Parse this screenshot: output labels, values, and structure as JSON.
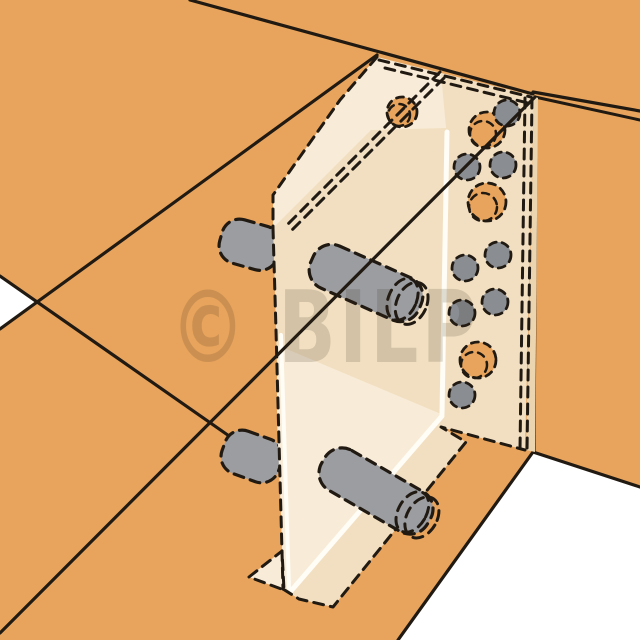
{
  "illustration": {
    "title": "timber-concealed-connector-diagram",
    "watermark": "© BILP",
    "canvas": {
      "width": 640,
      "height": 640
    },
    "colors": {
      "background": "#FFFFFF",
      "wood": "#E8A45C",
      "plate": "#F2DFC1",
      "plate_light": "#F8ECD8",
      "plate_edge": "#EBD5B1",
      "steel": "#9B9DA1",
      "pin": "#8A8D92",
      "line": "#211A12",
      "highlight": "#FFFDF5",
      "watermark_color": "#3A2F1E"
    },
    "watermark_style": {
      "x": 170,
      "y": 362,
      "size": 100,
      "text_length": 310,
      "opacity": 0.16
    },
    "shapes": [
      {
        "t": "rect",
        "n": "background",
        "x": 0,
        "y": 0,
        "w": 640,
        "h": 640,
        "f": "background"
      },
      {
        "t": "poly",
        "n": "wood-surfaces",
        "p": "0,0 640,0 640,640 0,640",
        "f": "wood"
      },
      {
        "t": "poly",
        "n": "background-notch-left",
        "p": "0,276 37,302 0,329",
        "f": "background"
      },
      {
        "t": "poly",
        "n": "background-opening-bottom-right",
        "p": "533,452 640,487 640,640 398,640",
        "f": "background"
      },
      {
        "t": "line",
        "n": "header-beam-top-edge",
        "x1": 190,
        "y1": 0,
        "x2": 533,
        "y2": 94,
        "s": "line",
        "sw": 3.2
      },
      {
        "t": "line",
        "n": "header-beam-bottom-edge",
        "x1": 0,
        "y1": 329,
        "x2": 377,
        "y2": 55,
        "s": "line",
        "sw": 3.2
      },
      {
        "t": "line",
        "n": "carried-beam-arris-left",
        "x1": 0,
        "y1": 276,
        "x2": 232,
        "y2": 438,
        "s": "line",
        "sw": 3.2
      },
      {
        "t": "line",
        "n": "carried-beam-end-edge",
        "x1": 371,
        "y1": 130,
        "x2": 273,
        "y2": 228,
        "s": "line",
        "sw": 3
      },
      {
        "t": "line",
        "n": "header-edge-right-upper",
        "x1": 533,
        "y1": 92,
        "x2": 640,
        "y2": 111,
        "s": "line",
        "sw": 3.2
      },
      {
        "t": "line",
        "n": "header-edge-right-lower",
        "x1": 535,
        "y1": 97,
        "x2": 640,
        "y2": 120,
        "s": "line",
        "sw": 3
      },
      {
        "t": "line",
        "n": "post-front-arris",
        "x1": 536,
        "y1": 98,
        "x2": 534,
        "y2": 452,
        "s": "line",
        "sw": 3.2
      },
      {
        "t": "line",
        "n": "post-base-edge-right",
        "x1": 533,
        "y1": 452,
        "x2": 640,
        "y2": 487,
        "s": "line",
        "sw": 3.2
      },
      {
        "t": "line",
        "n": "post-base-edge-left",
        "x1": 533,
        "y1": 452,
        "x2": 398,
        "y2": 640,
        "s": "line",
        "sw": 3.2
      },
      {
        "t": "rect",
        "n": "dowel-end-upper",
        "x": 220,
        "y": 222,
        "w": 60,
        "h": 45,
        "rx": 18,
        "tf": "rotate(16 249 244)",
        "f": "steel",
        "s": "line",
        "sw": 3.2,
        "d": 1
      },
      {
        "t": "rect",
        "n": "dowel-end-lower",
        "x": 222,
        "y": 434,
        "w": 60,
        "h": 45,
        "rx": 18,
        "tf": "rotate(20 252 456)",
        "f": "steel",
        "s": "line",
        "sw": 3.2,
        "d": 1
      },
      {
        "t": "poly",
        "n": "plate-body",
        "p": "377,57 534,96 525,450 441,427 466,442 333,607 299,599 283,589 276,330 273,228 273,195 340,100",
        "f": "plate"
      },
      {
        "t": "poly",
        "n": "plate-flange-top",
        "p": "377,57 441,74 446,128 371,130 273,228 273,195 340,100",
        "f": "plate_light"
      },
      {
        "t": "poly",
        "n": "plate-lower-left-face",
        "p": "277,345 441,414 291,590 284,588 277,420",
        "f": "plate_light"
      },
      {
        "t": "poly",
        "n": "plate-edge-strip",
        "p": "534,96 538,98 535,452 526,450",
        "f": "plate_edge"
      },
      {
        "t": "poly",
        "n": "plate-foot-flange",
        "p": "249,577 282,551 284,590",
        "f": "plate_light",
        "s": "line",
        "sw": 3,
        "d": 1
      },
      {
        "t": "line",
        "n": "plate-fold-highlight-upper",
        "x1": 447,
        "y1": 132,
        "x2": 442,
        "y2": 414,
        "s": "highlight",
        "sw": 5
      },
      {
        "t": "line",
        "n": "plate-fold-highlight-lower",
        "x1": 442,
        "y1": 416,
        "x2": 291,
        "y2": 591,
        "s": "highlight",
        "sw": 5
      },
      {
        "t": "line",
        "n": "plate-edge-highlight-left",
        "x1": 281,
        "y1": 335,
        "x2": 289,
        "y2": 588,
        "s": "highlight",
        "sw": 4
      },
      {
        "t": "pline",
        "n": "plate-top-edge-dashed-outer",
        "p": "379,60 531,97",
        "s": "line",
        "sw": 3,
        "d": 1
      },
      {
        "t": "pline",
        "n": "plate-top-edge-dashed-inner",
        "p": "385,68 528,103",
        "s": "line",
        "sw": 3,
        "d": 1
      },
      {
        "t": "pline",
        "n": "plate-left-edge-dashed",
        "p": "377,57 340,100 273,195 273,228",
        "s": "line",
        "sw": 3,
        "d": 1
      },
      {
        "t": "pline",
        "n": "plate-side-edge-dashed",
        "p": "273,228 276,330 283,589",
        "s": "line",
        "sw": 3,
        "d": 1
      },
      {
        "t": "pline",
        "n": "plate-bottom-edge-dashed",
        "p": "283,589 299,599 333,607 466,442 441,427 525,450",
        "s": "line",
        "sw": 3,
        "d": 1
      },
      {
        "t": "pline",
        "n": "plate-right-edge-dashed-outer",
        "p": "532,98 527,451",
        "s": "line",
        "sw": 3,
        "d": 1
      },
      {
        "t": "pline",
        "n": "plate-right-edge-dashed-inner",
        "p": "525,98 520,449",
        "s": "line",
        "sw": 3,
        "d": 1
      },
      {
        "t": "circle",
        "n": "flange-hole",
        "cx": 402,
        "cy": 112,
        "r": 15,
        "f": "wood",
        "s": "line",
        "sw": 2.8,
        "d": 2
      },
      {
        "t": "circle",
        "n": "flange-hole-rim",
        "cx": 399,
        "cy": 115,
        "r": 11,
        "s": "line",
        "sw": 2.5,
        "d": 2
      },
      {
        "t": "circle",
        "n": "plate-hole-1",
        "cx": 487,
        "cy": 130,
        "r": 18,
        "f": "wood",
        "s": "line",
        "sw": 2.8,
        "d": 2
      },
      {
        "t": "circle",
        "n": "plate-hole-1-rim",
        "cx": 483,
        "cy": 134,
        "r": 13,
        "s": "line",
        "sw": 2.5,
        "d": 2
      },
      {
        "t": "circle",
        "n": "plate-hole-2",
        "cx": 487,
        "cy": 202,
        "r": 19,
        "f": "wood",
        "s": "line",
        "sw": 2.8,
        "d": 2
      },
      {
        "t": "circle",
        "n": "plate-hole-2-rim",
        "cx": 483,
        "cy": 207,
        "r": 14,
        "s": "line",
        "sw": 2.5,
        "d": 2
      },
      {
        "t": "circle",
        "n": "plate-hole-3",
        "cx": 478,
        "cy": 360,
        "r": 18,
        "f": "wood",
        "s": "line",
        "sw": 2.8,
        "d": 2
      },
      {
        "t": "circle",
        "n": "plate-hole-3-rim",
        "cx": 474,
        "cy": 365,
        "r": 13,
        "s": "line",
        "sw": 2.5,
        "d": 2
      },
      {
        "t": "pline",
        "n": "hidden-beam-edge-dashed-a",
        "p": "440,72 284,228",
        "s": "line",
        "sw": 3,
        "d": 1
      },
      {
        "t": "pline",
        "n": "hidden-beam-edge-dashed-b",
        "p": "444,78 288,234",
        "s": "line",
        "sw": 3,
        "d": 1
      },
      {
        "t": "circle",
        "n": "fastener-pin-1",
        "cx": 507,
        "cy": 113,
        "r": 13,
        "f": "pin",
        "s": "line",
        "sw": 2.8,
        "d": 2
      },
      {
        "t": "circle",
        "n": "fastener-pin-2",
        "cx": 467,
        "cy": 167,
        "r": 13,
        "f": "pin",
        "s": "line",
        "sw": 2.8,
        "d": 2
      },
      {
        "t": "circle",
        "n": "fastener-pin-3",
        "cx": 503,
        "cy": 165,
        "r": 13,
        "f": "pin",
        "s": "line",
        "sw": 2.8,
        "d": 2
      },
      {
        "t": "circle",
        "n": "fastener-pin-4",
        "cx": 498,
        "cy": 255,
        "r": 13,
        "f": "pin",
        "s": "line",
        "sw": 2.8,
        "d": 2
      },
      {
        "t": "circle",
        "n": "fastener-pin-5",
        "cx": 465,
        "cy": 268,
        "r": 13,
        "f": "pin",
        "s": "line",
        "sw": 2.8,
        "d": 2
      },
      {
        "t": "circle",
        "n": "fastener-pin-6",
        "cx": 495,
        "cy": 302,
        "r": 13,
        "f": "pin",
        "s": "line",
        "sw": 2.8,
        "d": 2
      },
      {
        "t": "circle",
        "n": "fastener-pin-7",
        "cx": 462,
        "cy": 313,
        "r": 13,
        "f": "pin",
        "s": "line",
        "sw": 2.8,
        "d": 2
      },
      {
        "t": "circle",
        "n": "fastener-pin-8",
        "cx": 462,
        "cy": 395,
        "r": 13,
        "f": "pin",
        "s": "line",
        "sw": 2.8,
        "d": 2
      },
      {
        "t": "rect",
        "n": "dowel-middle-body",
        "x": 307,
        "y": 260,
        "w": 118,
        "h": 46,
        "rx": 20,
        "tf": "rotate(24 366 283)",
        "f": "steel",
        "s": "line",
        "sw": 3.2,
        "d": 1
      },
      {
        "t": "ellipse",
        "n": "dowel-middle-rim-inner",
        "cx": 406,
        "cy": 283,
        "rx": 14,
        "ry": 22,
        "tf": "rotate(24 366 283)",
        "s": "line",
        "sw": 3,
        "d": 1
      },
      {
        "t": "ellipse",
        "n": "dowel-middle-rim-outer",
        "cx": 416,
        "cy": 283,
        "rx": 15,
        "ry": 22,
        "tf": "rotate(24 366 283)",
        "s": "line",
        "sw": 3,
        "d": 1
      },
      {
        "t": "rect",
        "n": "dowel-bottom-body",
        "x": 315,
        "y": 468,
        "w": 122,
        "h": 46,
        "rx": 20,
        "tf": "rotate(30 376 491)",
        "f": "steel",
        "s": "line",
        "sw": 3.2,
        "d": 1
      },
      {
        "t": "ellipse",
        "n": "dowel-bottom-rim-inner",
        "cx": 418,
        "cy": 491,
        "rx": 14,
        "ry": 22,
        "tf": "rotate(30 376 491)",
        "s": "line",
        "sw": 3,
        "d": 1
      },
      {
        "t": "ellipse",
        "n": "dowel-bottom-rim-outer",
        "cx": 429,
        "cy": 491,
        "rx": 15,
        "ry": 22,
        "tf": "rotate(30 376 491)",
        "s": "line",
        "sw": 3,
        "d": 1
      },
      {
        "t": "line",
        "n": "carried-beam-hidden-arris",
        "x1": 535,
        "y1": 97,
        "x2": 0,
        "y2": 633,
        "s": "line",
        "sw": 3.2
      }
    ]
  }
}
